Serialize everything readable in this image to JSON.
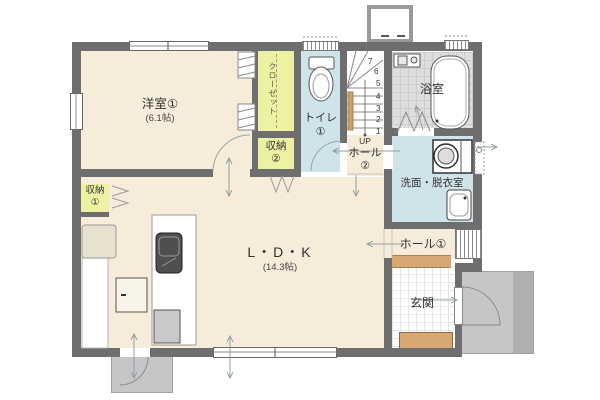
{
  "rooms": {
    "western_room": {
      "name": "洋室①",
      "size": "(6.1帖)"
    },
    "closet": {
      "name": "クローゼット"
    },
    "storage2": {
      "name": "収納",
      "number": "②"
    },
    "storage1": {
      "name": "収納",
      "number": "①"
    },
    "toilet": {
      "name": "トイレ",
      "number": "①"
    },
    "hall2": {
      "up": "UP",
      "name": "ホール",
      "number": "②"
    },
    "bathroom": {
      "name": "浴室"
    },
    "washroom": {
      "name": "洗面・脱衣室"
    },
    "hall1": {
      "name": "ホール①"
    },
    "ldk": {
      "name": "L・D・K",
      "size": "(14.3帖)"
    },
    "entrance": {
      "name": "玄関"
    }
  },
  "stairs": {
    "numbers": [
      "7",
      "6",
      "5",
      "4",
      "3",
      "2",
      "1"
    ]
  },
  "colors": {
    "wall": "#6e6e6e",
    "floor": "#f7ecd9",
    "storage": "#eef0a2",
    "water_rooms": "#cfe3ea",
    "bath_floor": "#dedede",
    "wood_step": "#d8a873",
    "porch": "#c6c6c8",
    "arrows": "#8fa0a0"
  }
}
